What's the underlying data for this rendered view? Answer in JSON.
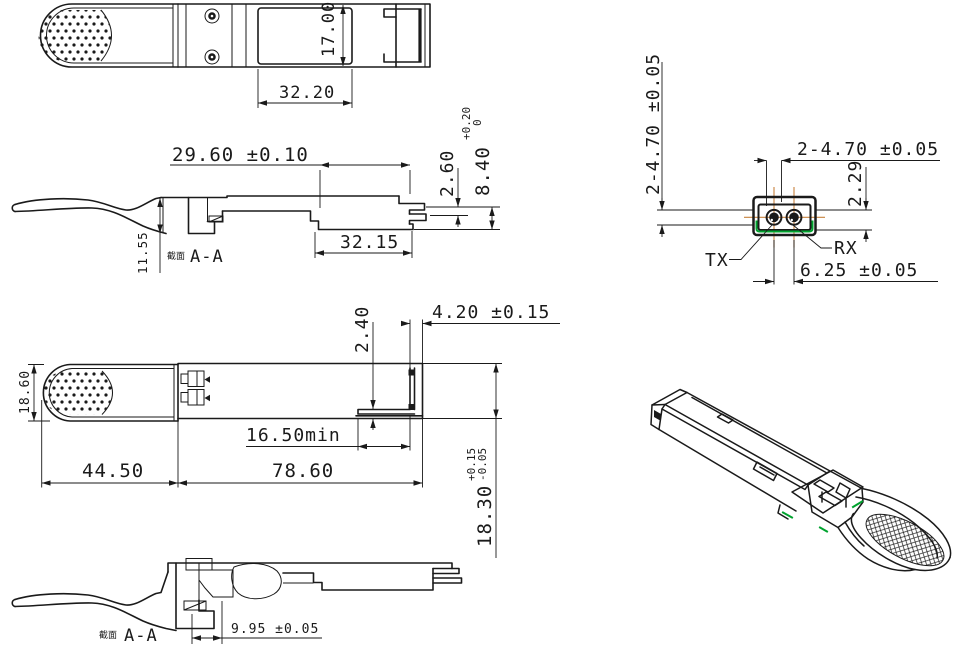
{
  "drawing": {
    "top_view": {
      "dim_height": "17.00",
      "dim_width": "32.20"
    },
    "side_section": {
      "section_label_prefix": "截面",
      "section_label": "A-A",
      "dim_length": "29.60 ±0.10",
      "dim_length2": "32.15",
      "dim_step": "2.60",
      "dim_module_height": "8.40",
      "dim_module_height_tol_upper": "+0.20",
      "dim_module_height_tol_lower": "0",
      "dim_tab_height": "11.55"
    },
    "connector_face": {
      "dim_port_dia_vertical": "2-4.70 ±0.05",
      "dim_port_dia_horizontal": "2-4.70 ±0.05",
      "dim_offset": "2.29",
      "tx_label": "TX",
      "rx_label": "RX",
      "dim_port_pitch": "6.25 ±0.05"
    },
    "bottom_view": {
      "dim_tab_width": "18.60",
      "dim_tab_length": "44.50",
      "dim_body_length": "78.60",
      "dim_min_clearance": "16.50min",
      "dim_notch": "2.40",
      "dim_end_offset": "4.20 ±0.15",
      "dim_body_width": "18.30",
      "dim_body_width_tol_upper": "+0.15",
      "dim_body_width_tol_lower": "-0.05"
    },
    "bottom_section": {
      "section_label_prefix": "截面",
      "section_label": "A-A",
      "dim_boot": "9.95 ±0.05"
    },
    "colors": {
      "line": "#1a1a1a",
      "centerline_orange": "#c8823e",
      "accent_green": "#00a32e",
      "background": "#ffffff"
    }
  }
}
